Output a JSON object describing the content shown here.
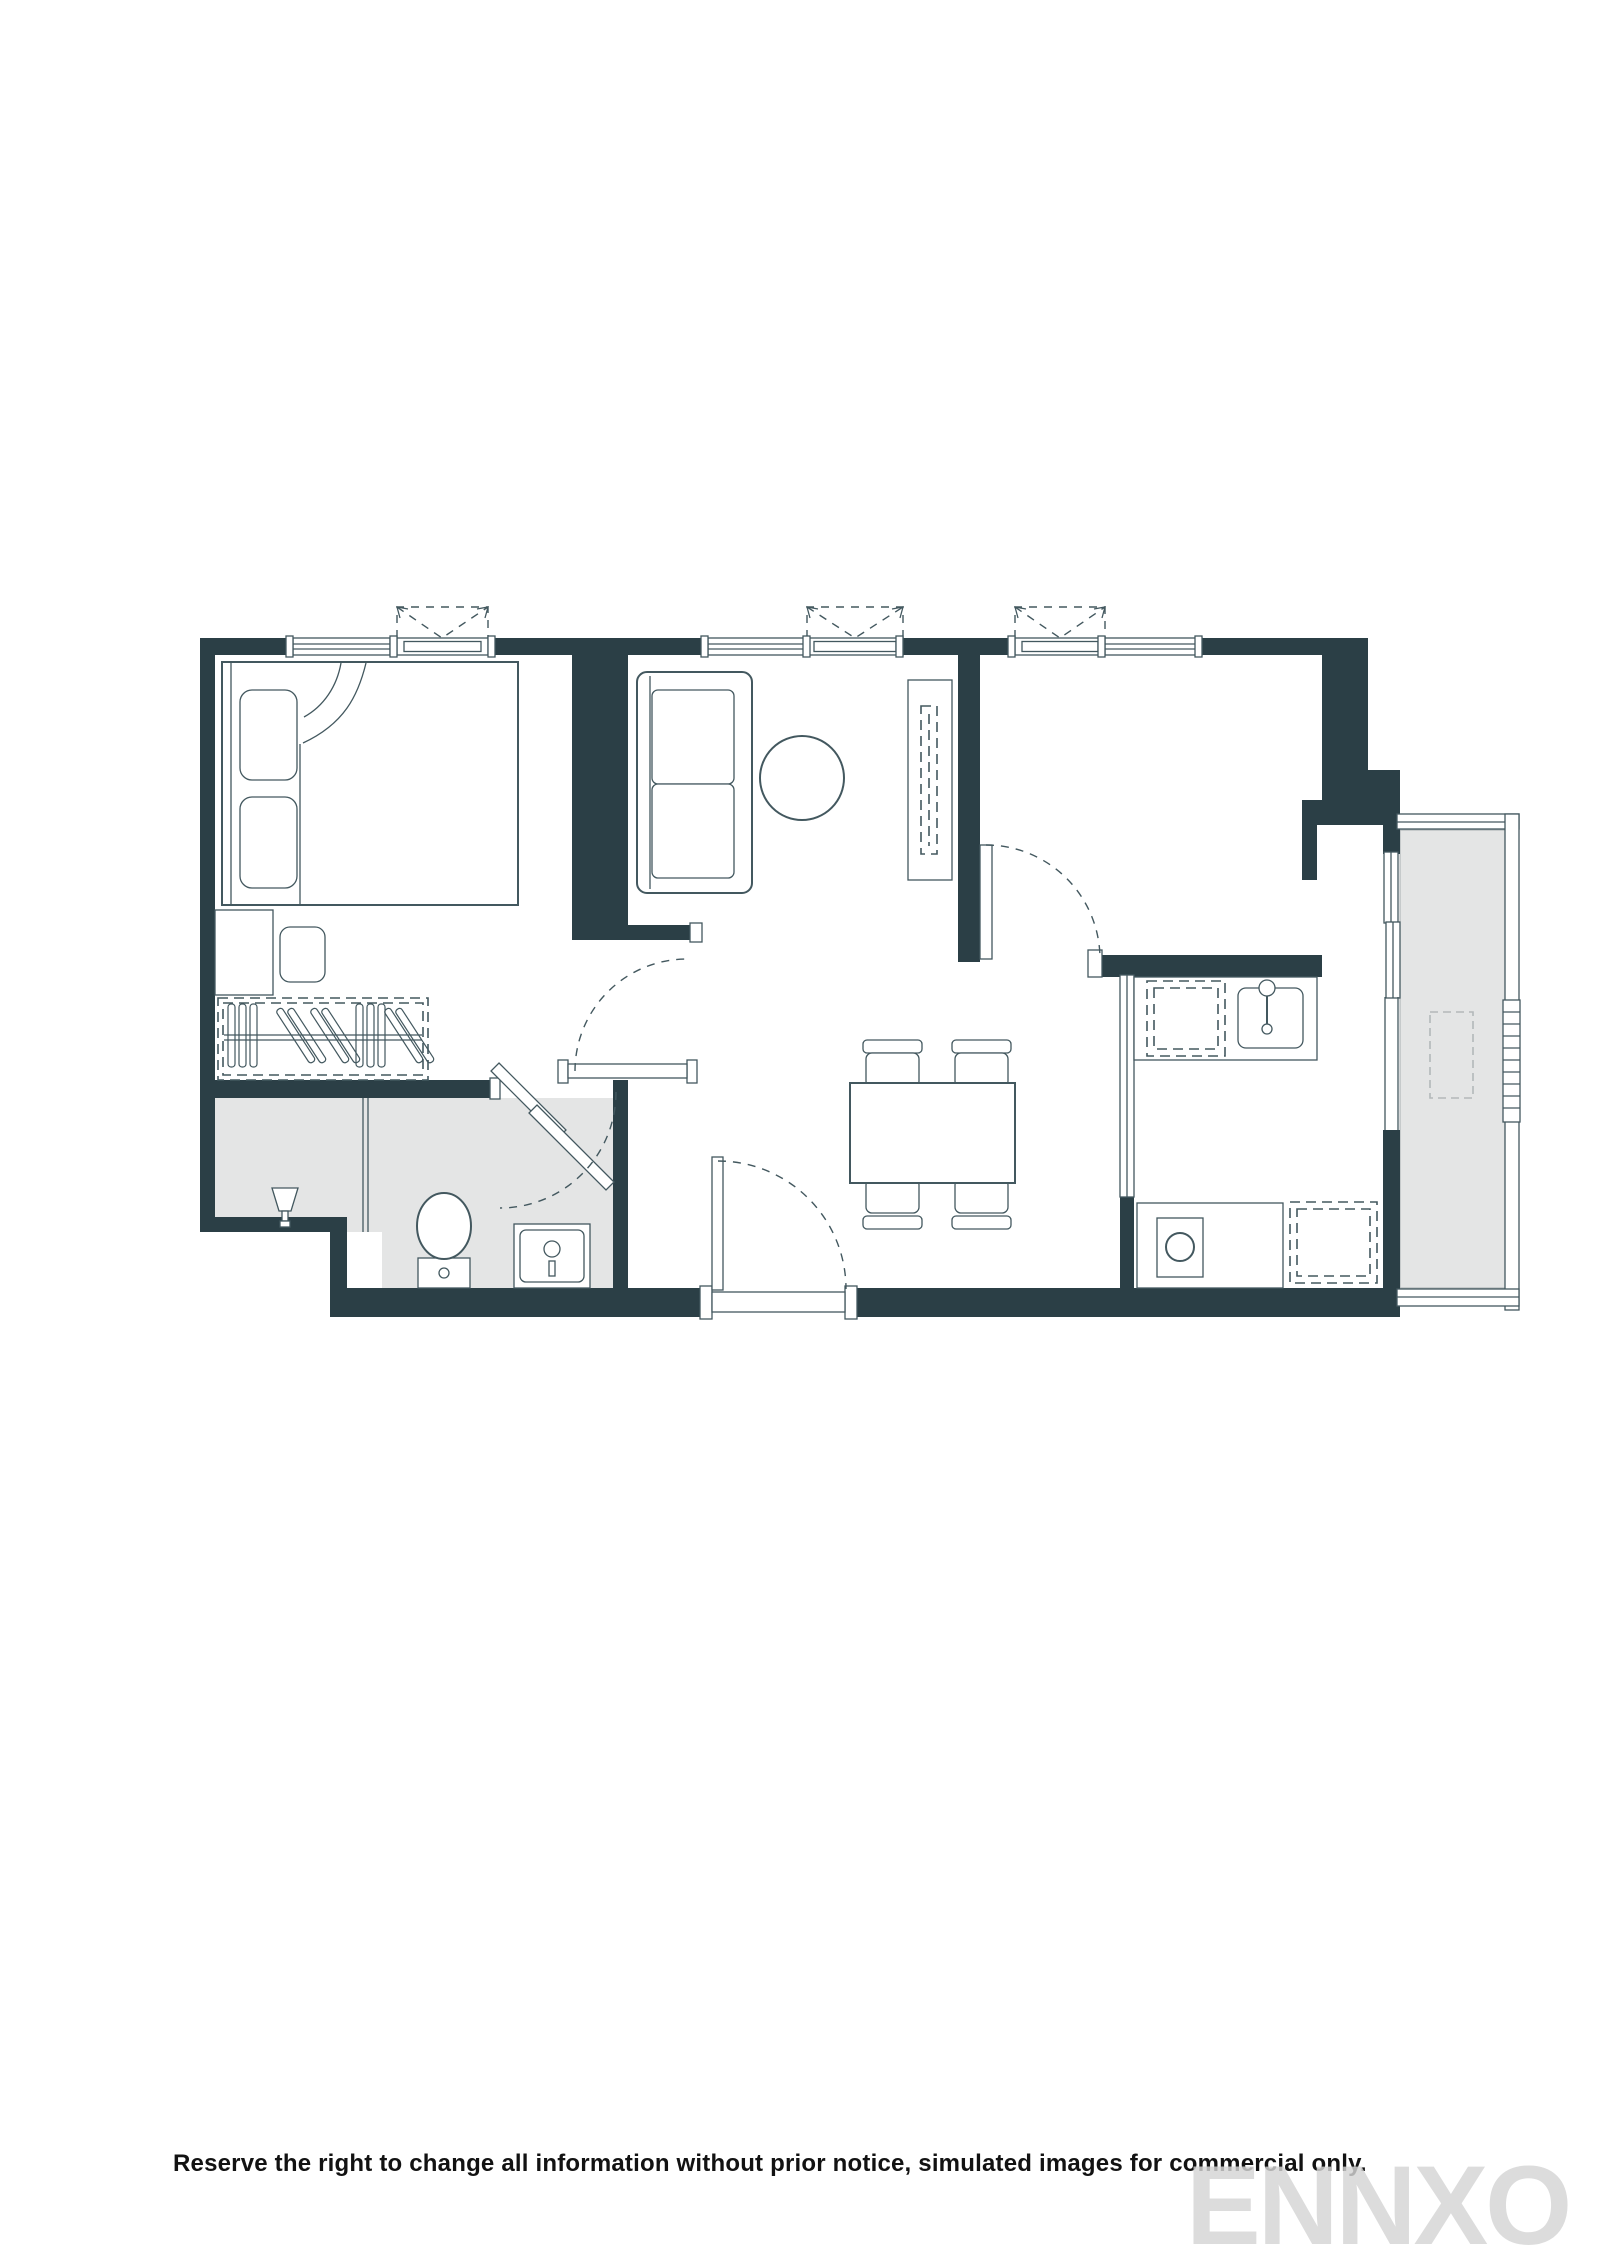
{
  "colors": {
    "wall": "#2b3f46",
    "line": "#43585f",
    "line_light": "#b3b8ba",
    "floor": "#e4e5e5",
    "ink": "#121212",
    "watermark": "#d5d5d5"
  },
  "footer": {
    "disclaimer": "Reserve the right to change all information without prior notice, simulated images for commercial only.",
    "watermark": "ENNXO"
  }
}
